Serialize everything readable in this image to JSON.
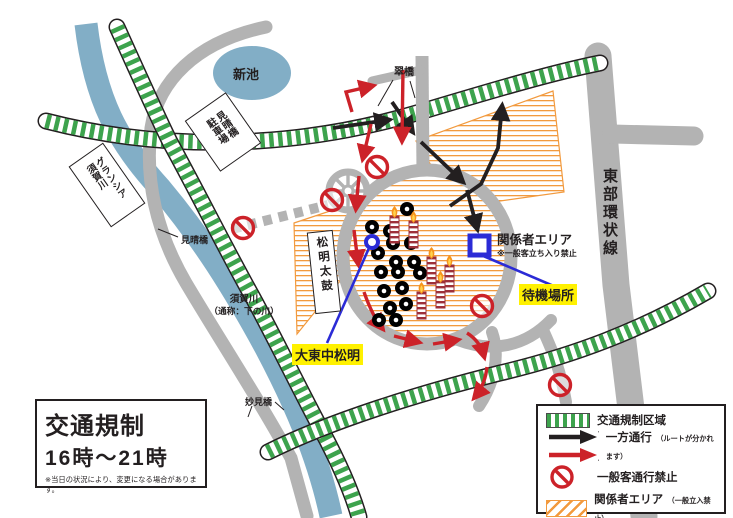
{
  "map": {
    "pond_label": "新池",
    "bridge_top_label": "翠橋",
    "parking_label": "見晴橋駐車場",
    "hotel_label": "グランシア須賀川",
    "bridge_left_label": "見晴橋",
    "river_label_line1": "須賀川",
    "river_label_line2": "（通称：下の川）",
    "taiko_label": "松明太鼓",
    "staff_area_title": "関係者エリア",
    "staff_area_note": "※一般客立ち入り禁止",
    "waiting_label": "待機場所",
    "torch_label": "大東中松明",
    "ring_road_label": "東部環状線",
    "bridge_bottom_label": "妙見橋"
  },
  "info_box": {
    "title": "交通規制",
    "time": "16時～21時",
    "note": "※当日の状況により、変更になる場合があります。"
  },
  "legend": {
    "items": [
      {
        "icon": "green-hatch-swatch",
        "label": "交通規制区域",
        "note": ""
      },
      {
        "icon": "one-way-arrows",
        "label": "一方通行",
        "note": "（ルートが分かれます）"
      },
      {
        "icon": "no-entry",
        "label": "一般客通行禁止",
        "note": ""
      },
      {
        "icon": "orange-hatch-swatch",
        "label": "関係者エリア",
        "note": "（一般立入禁止）"
      }
    ]
  },
  "colors": {
    "river_blue": "#82aec6",
    "road_gray": "#b3b3b3",
    "regulation_green": "#3da34d",
    "staff_orange": "#f29a3e",
    "route_red": "#cc2229",
    "route_black": "#231f20",
    "marker_blue": "#2b2bd6",
    "highlight_yellow": "#fff100",
    "torch_maroon": "#9e3039",
    "flame_orange": "#f7941d"
  }
}
